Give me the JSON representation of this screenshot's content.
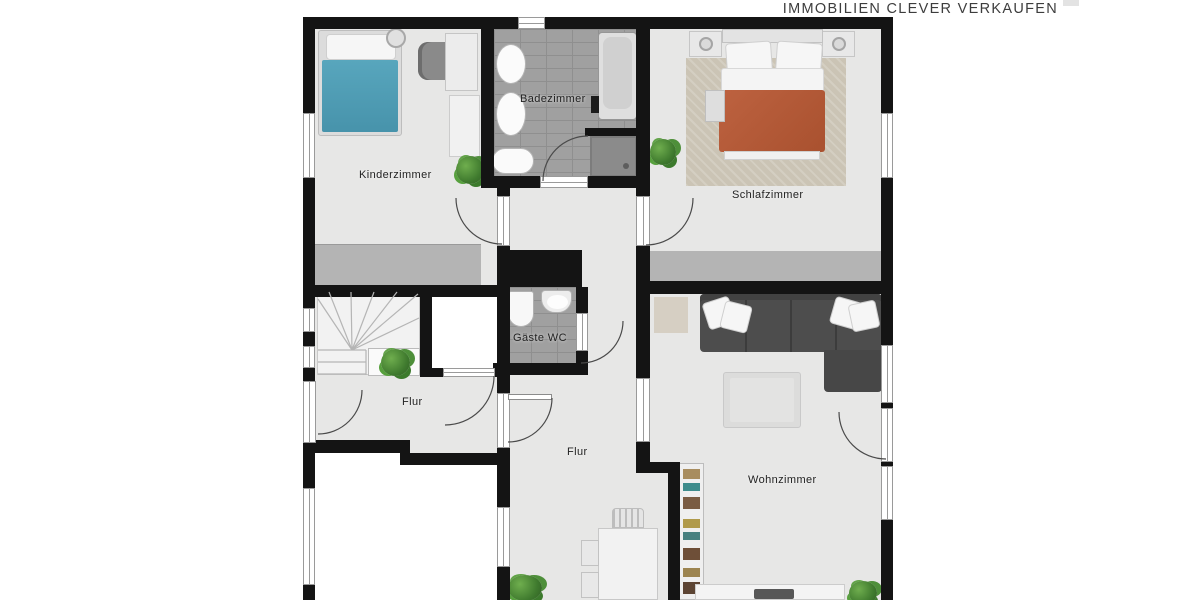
{
  "branding": {
    "tagline": "IMMOBILIEN CLEVER VERKAUFEN"
  },
  "rooms": {
    "kinderzimmer": "Kinderzimmer",
    "badezimmer": "Badezimmer",
    "schlafzimmer": "Schlafzimmer",
    "gaeste_wc": "Gäste WC",
    "flur_upper": "Flur",
    "flur_lower": "Flur",
    "wohnzimmer": "Wohnzimmer"
  },
  "colors": {
    "wall": "#141414",
    "floor": "#e7e7e6",
    "tile": "#a0a0a0",
    "kids_bed_blanket": "#4f9fb7",
    "master_bed_blanket": "#b55b3a",
    "sofa": "#4d4d4d",
    "rug": "#cbc4b5",
    "plant": "#4e8f3a"
  }
}
